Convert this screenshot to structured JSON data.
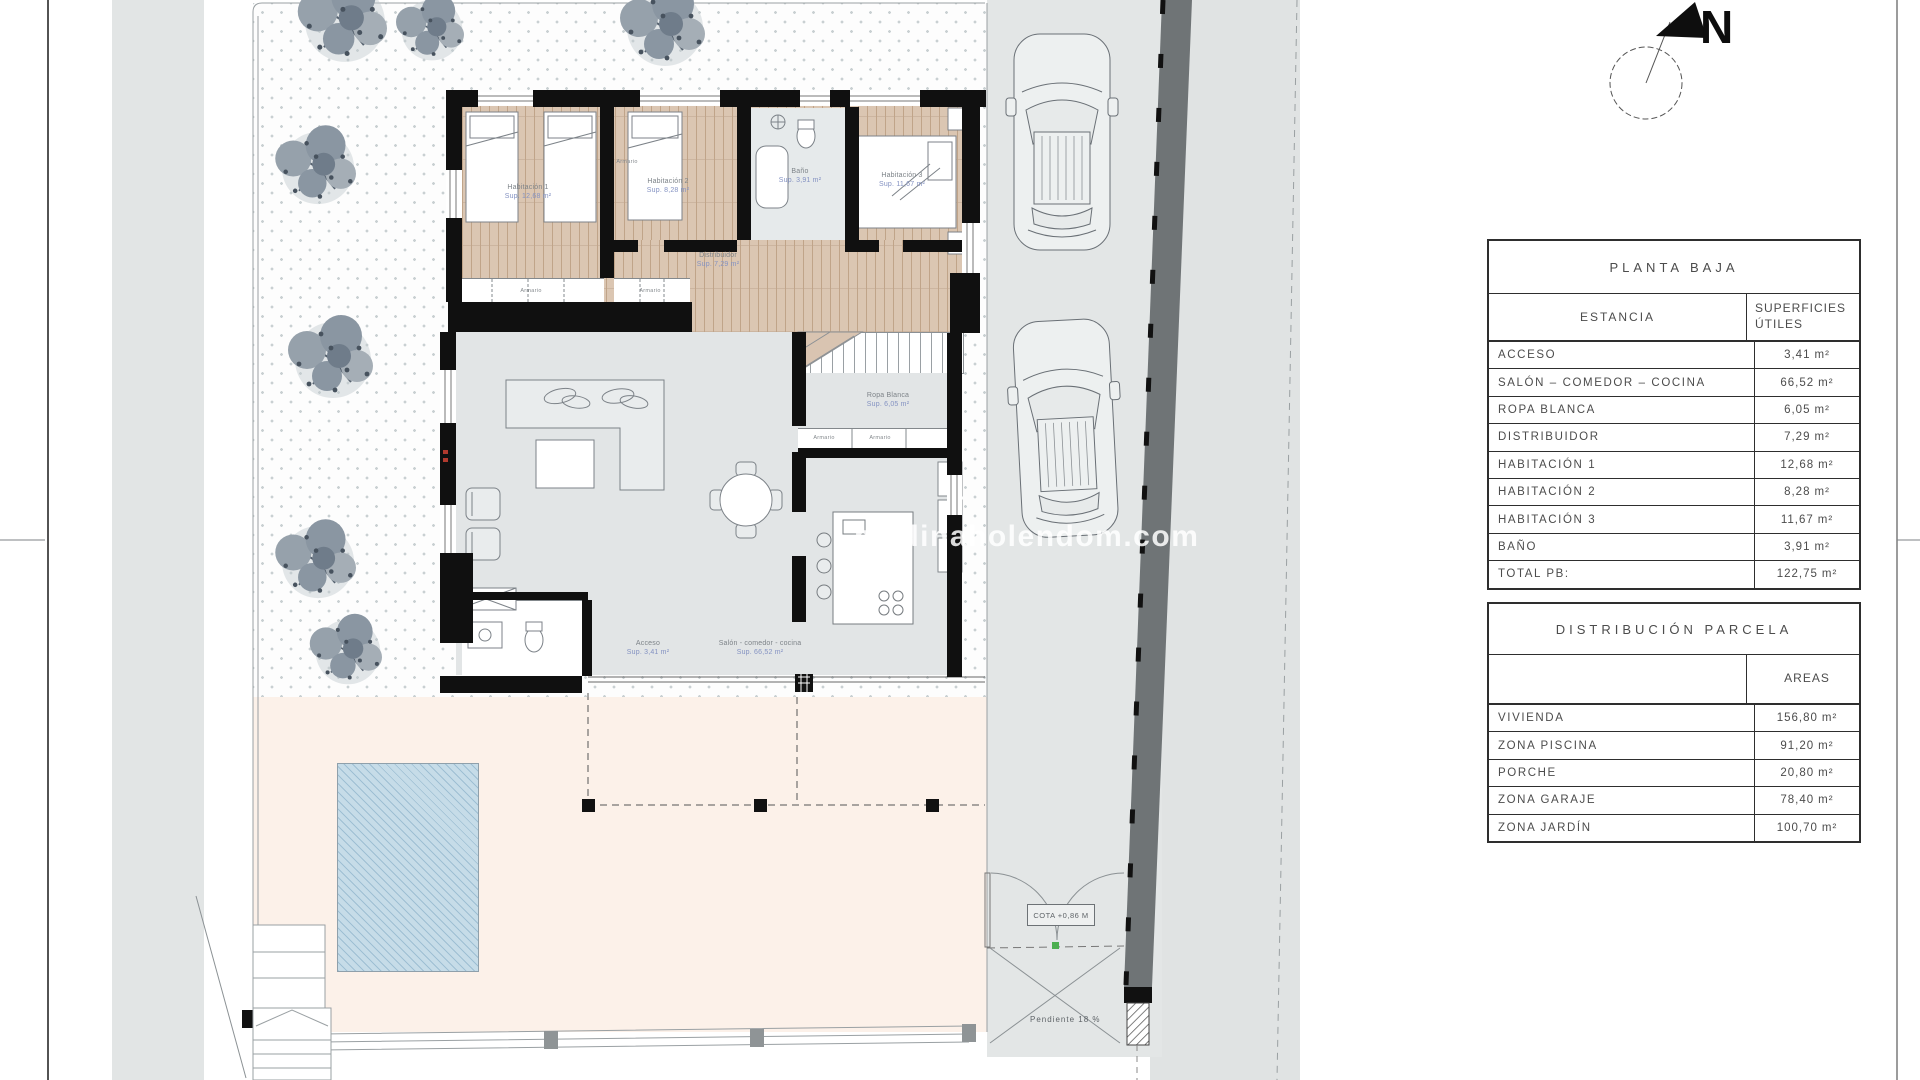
{
  "compass": {
    "label": "N"
  },
  "watermark": {
    "text": "medinaholendom.com"
  },
  "tables": {
    "planta_baja": {
      "title": "PLANTA BAJA",
      "col1_header": "ESTANCIA",
      "col2_header_line1": "SUPERFICIES",
      "col2_header_line2": "ÚTILES",
      "unit": "m²",
      "rows": [
        {
          "label": "ACCESO",
          "value": "3,41"
        },
        {
          "label": "SALÓN – COMEDOR – COCINA",
          "value": "66,52"
        },
        {
          "label": "ROPA BLANCA",
          "value": "6,05"
        },
        {
          "label": "DISTRIBUIDOR",
          "value": "7,29"
        },
        {
          "label": "HABITACIÓN 1",
          "value": "12,68"
        },
        {
          "label": "HABITACIÓN 2",
          "value": "8,28"
        },
        {
          "label": "HABITACIÓN 3",
          "value": "11,67"
        },
        {
          "label": "BAÑO",
          "value": "3,91"
        },
        {
          "label": "TOTAL PB:",
          "value": "122,75"
        }
      ]
    },
    "distribucion_parcela": {
      "title": "DISTRIBUCIÓN PARCELA",
      "col2_header": "AREAS",
      "unit": "m²",
      "rows": [
        {
          "label": "VIVIENDA",
          "value": "156,80"
        },
        {
          "label": "ZONA PISCINA",
          "value": "91,20"
        },
        {
          "label": "PORCHE",
          "value": "20,80"
        },
        {
          "label": "ZONA GARAJE",
          "value": "78,40"
        },
        {
          "label": "ZONA JARDÍN",
          "value": "100,70"
        }
      ]
    }
  },
  "plan": {
    "closet_label": "Armario",
    "rooms": [
      {
        "name": "Habitación 1",
        "sup": "Sup. 12,68 m²"
      },
      {
        "name": "Habitación 2",
        "sup": "Sup. 8,28 m²"
      },
      {
        "name": "Habitación 3",
        "sup": "Sup. 11,67 m²"
      },
      {
        "name": "Baño",
        "sup": "Sup. 3,91 m²"
      },
      {
        "name": "Distribuidor",
        "sup": "Sup. 7,29 m²"
      },
      {
        "name": "Ropa Blanca",
        "sup": "Sup. 6,05 m²"
      },
      {
        "name": "Acceso",
        "sup": "Sup. 3,41 m²"
      },
      {
        "name": "Salón - comedor - cocina",
        "sup": "Sup. 66,52 m²"
      }
    ],
    "gate": {
      "cota": "COTA +0,86 M",
      "slope": "Pendiente 18 %"
    }
  }
}
